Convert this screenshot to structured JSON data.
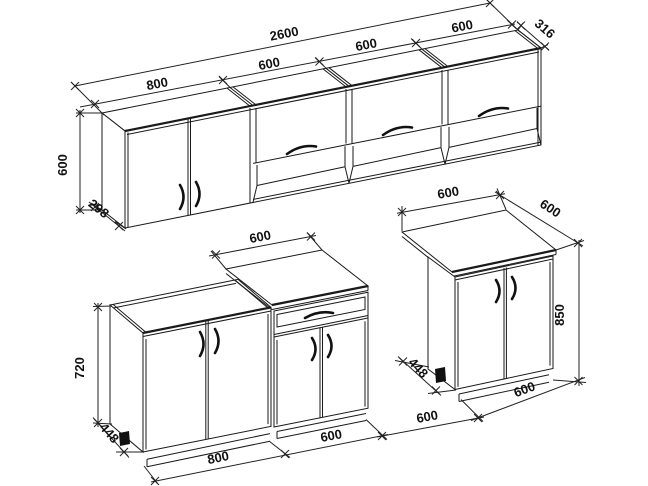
{
  "dims": {
    "wall": {
      "total": "2600",
      "seg1": "800",
      "seg2": "600",
      "seg3": "600",
      "seg4": "600",
      "depth_right": "316",
      "height": "600",
      "depth_left": "298"
    },
    "left_group": {
      "height": "720",
      "depth": "448",
      "sink_width": "800",
      "counter_width": "600",
      "countertop_width": "600"
    },
    "gap": {
      "width": "600"
    },
    "right_cab": {
      "top_width": "600",
      "top_depth": "600",
      "height": "850",
      "depth": "448",
      "bottom_width": "600"
    }
  },
  "colors": {
    "line": "#1a1a1a",
    "background": "#ffffff"
  }
}
